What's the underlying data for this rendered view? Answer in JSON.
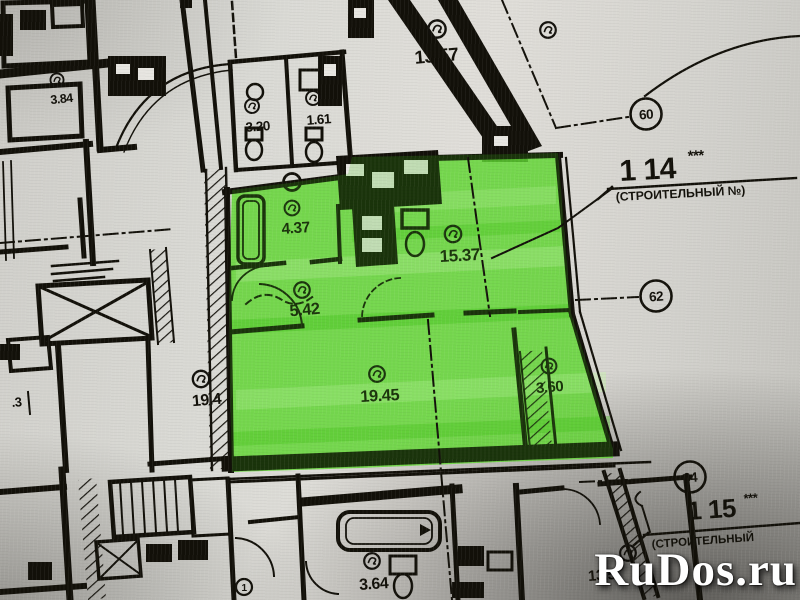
{
  "watermark": {
    "site": "RuDos.ru"
  },
  "colors": {
    "highlight": "#6edc3f",
    "highlight_dark": "#49c322",
    "highlight_light": "#c2f2a6",
    "ink": "#16140e",
    "paper": "#d8d7d2"
  },
  "rooms": {
    "r1357": {
      "area": "13.57"
    },
    "r384": {
      "area": "3.84"
    },
    "r320": {
      "area": "3.20"
    },
    "r161": {
      "area": "1.61"
    },
    "r437": {
      "area": "4.37"
    },
    "r542": {
      "area": "5.42"
    },
    "r1537": {
      "area": "15.37"
    },
    "r194": {
      "area": "19.4"
    },
    "r1945": {
      "area": "19.45"
    },
    "r360": {
      "area": "3.60"
    },
    "r364": {
      "area": "3.64"
    },
    "r135": {
      "area": "13.5"
    },
    "rdot3": {
      "area": ".3"
    }
  },
  "annotations": {
    "axis_badges": [
      {
        "label": "60"
      },
      {
        "label": "62"
      },
      {
        "label": "64"
      }
    ],
    "circled_one": "1",
    "apartment_callouts": [
      {
        "number": "1 14",
        "stars": "***",
        "note": "(СТРОИТЕЛЬНЫЙ №)"
      },
      {
        "number": "1 15",
        "stars": "***",
        "note": "(СТРОИТЕЛЬНЫЙ"
      }
    ]
  }
}
